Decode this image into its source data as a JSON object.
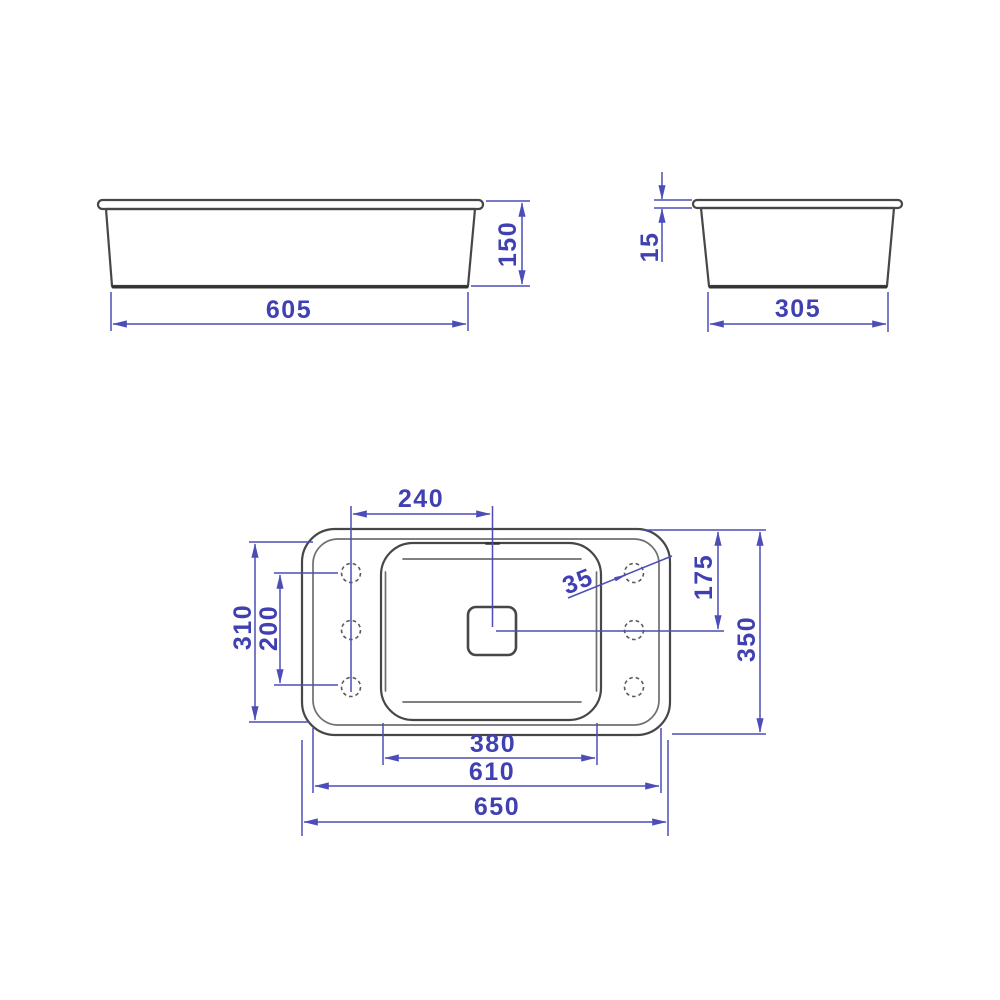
{
  "drawing": {
    "type": "technical-drawing",
    "subject": "rectangular basin / sink dimensional drawing",
    "unit": "mm",
    "colors": {
      "outline": "#474747",
      "dimension_line": "#4d4db8",
      "dimension_text": "#4040b2",
      "background": "#ffffff"
    },
    "views": {
      "front": {
        "label": "front view",
        "width": "605",
        "height": "150"
      },
      "side": {
        "label": "side view",
        "width": "305",
        "rim_thickness": "15"
      },
      "plan": {
        "label": "top view",
        "overall_width": "650",
        "rim_width": "610",
        "bowl_width": "380",
        "overall_depth": "350",
        "bowl_depth": "310",
        "hole_span": "200",
        "drain_offset_from_hole_column": "240",
        "center_offset_from_top_edge": "175",
        "hole_diameter": "35"
      }
    }
  }
}
